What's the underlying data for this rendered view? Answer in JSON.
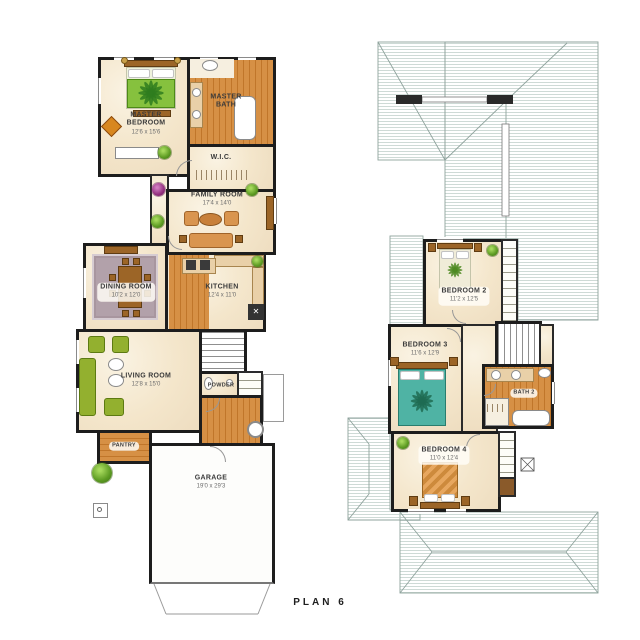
{
  "title": "PLAN 6",
  "floor1": {
    "rooms": {
      "master_bedroom": {
        "name": "MASTER BEDROOM",
        "dims": "12'6 x 15'6"
      },
      "master_bath": {
        "name": "MASTER BATH"
      },
      "wic": {
        "name": "W.I.C."
      },
      "family_room": {
        "name": "FAMILY ROOM",
        "dims": "17'4 x 14'0"
      },
      "dining_room": {
        "name": "DINING ROOM",
        "dims": "10'2 x 12'0"
      },
      "kitchen": {
        "name": "KITCHEN",
        "dims": "12'4 x 11'0"
      },
      "living_room": {
        "name": "LIVING ROOM",
        "dims": "12'8 x 15'0"
      },
      "powder": {
        "name": "POWDER"
      },
      "pantry": {
        "name": "PANTRY"
      },
      "garage": {
        "name": "GARAGE",
        "dims": "19'0 x 29'3"
      }
    }
  },
  "floor2": {
    "rooms": {
      "bedroom_2": {
        "name": "BEDROOM 2",
        "dims": "11'2 x 12'5"
      },
      "bedroom_3": {
        "name": "BEDROOM 3",
        "dims": "11'6 x 12'9"
      },
      "bedroom_4": {
        "name": "BEDROOM 4",
        "dims": "11'0 x 12'4"
      },
      "bath_2": {
        "name": "BATH 2"
      }
    }
  },
  "colors": {
    "wall": "#1d1d1d",
    "wood_floor": "#d69045",
    "cream_floor": "#f4e6cb",
    "roof_hatch": "#b9cac4",
    "accent_green": "#5c9a22",
    "teal_bed": "#4fb3a4",
    "dining_rug": "#b2a1aa"
  }
}
